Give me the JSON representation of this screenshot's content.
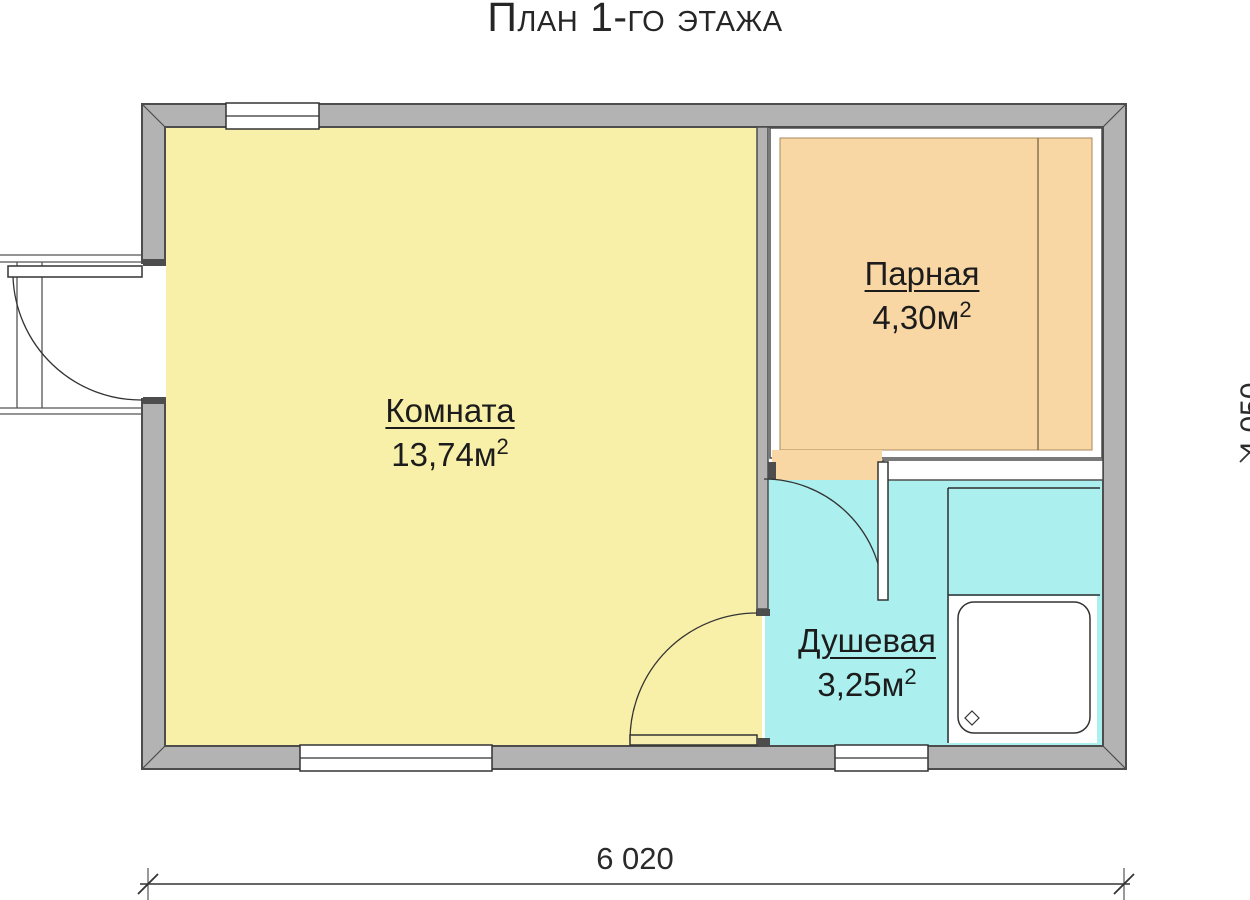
{
  "title": "План 1-го этажа",
  "rooms": [
    {
      "name": "Комната",
      "area_value": "13,74м",
      "area_sup": "2"
    },
    {
      "name": "Парная",
      "area_value": "4,30м",
      "area_sup": "2"
    },
    {
      "name": "Душевая",
      "area_value": "3,25м",
      "area_sup": "2"
    }
  ],
  "dimensions": {
    "horizontal": "6 020",
    "vertical": "4 050"
  },
  "colors": {
    "wall_fill": "#b3b3b3",
    "wall_outline": "#4d4d4d",
    "room_fill": "#f8f0a8",
    "sauna_fill": "#f9d7a5",
    "shower_fill": "#abf0ee"
  }
}
